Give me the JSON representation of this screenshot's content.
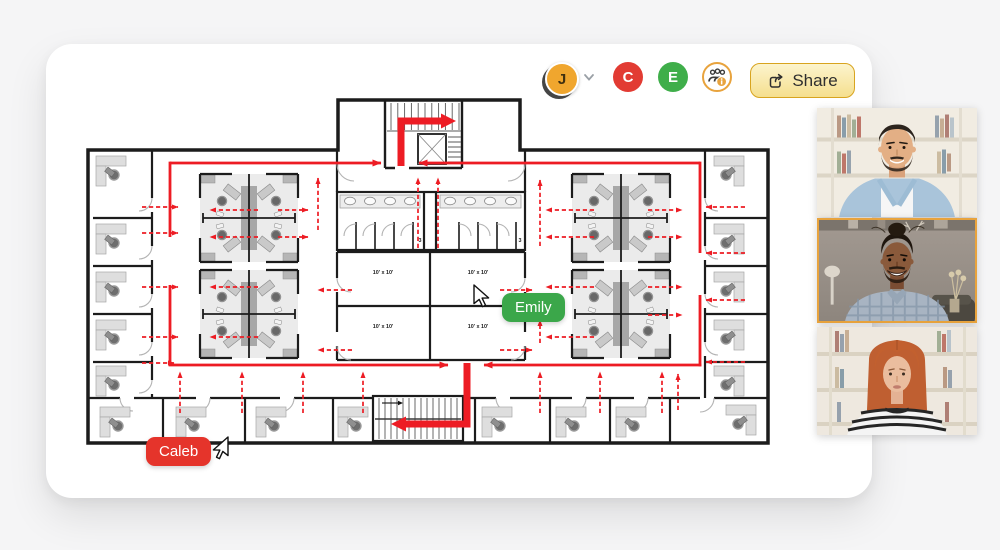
{
  "app": {
    "background": "#f5f5f6",
    "canvas_color": "#ffffff"
  },
  "toolbar": {
    "user_menu": {
      "initial": "J",
      "color": "#F0A62E",
      "chevron_icon": "chevron-down"
    },
    "collaborators": [
      {
        "initial": "C",
        "color": "#E23B33"
      },
      {
        "initial": "E",
        "color": "#3FAE4A"
      }
    ],
    "collaborators_button": {
      "icon": "people-info",
      "accent": "#E8A33D"
    },
    "share_button": {
      "label": "Share",
      "icon": "share-arrow",
      "background": "#FAEFBE",
      "border": "#D8A41F"
    }
  },
  "cursors": [
    {
      "name": "Emily",
      "color": "#3BA74A"
    },
    {
      "name": "Caleb",
      "color": "#E5342B"
    }
  ],
  "floor_plan": {
    "type": "office-evacuation-plan",
    "wall_color": "#1C1C1C",
    "route_color": "#ED1C24",
    "room_labels": [
      "10' x 10'",
      "10' x 10'",
      "10' x 10'",
      "10' x 10'"
    ],
    "bathroom_labels": [
      "3",
      "3"
    ]
  },
  "video_call": {
    "participants": [
      {
        "id": "participant-1",
        "description": "man with beard, blue shirt, bookshelf background",
        "active_speaker": false
      },
      {
        "id": "participant-2",
        "description": "smiling man with plaid shirt",
        "active_speaker": true,
        "highlight_color": "#E8A33D"
      },
      {
        "id": "participant-3",
        "description": "woman with red hair, striped top",
        "active_speaker": false
      }
    ]
  }
}
